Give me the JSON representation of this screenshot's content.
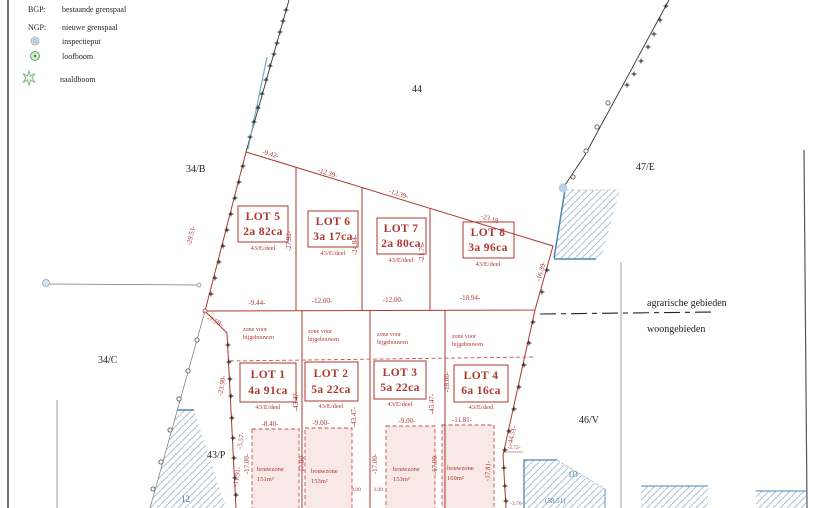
{
  "legend": {
    "bgp_key": "BGP:",
    "bgp_label": "bestaande grenspaal",
    "ngp_key": "NGP:",
    "ngp_label": "nieuwe grenspaal",
    "inspectieput": "inspectieput",
    "loofboom": "loofboom",
    "naaldboom": "naaldboom"
  },
  "parcels": {
    "top": "44",
    "upper_left": "34/B",
    "upper_right": "47/E",
    "mid_left": "34/C",
    "lower_left": "43/P",
    "lower_right": "46/V",
    "blue_left": "12",
    "blue_right": "1D",
    "blue_area": "(58.51)"
  },
  "zoning": {
    "above": "agrarische gebieden",
    "below": "woongebieden"
  },
  "lots": {
    "upper": [
      {
        "name": "LOT 5",
        "area": "2a 82ca",
        "ref": "43/E/deel"
      },
      {
        "name": "LOT 6",
        "area": "3a 17ca",
        "ref": "43/E/deel"
      },
      {
        "name": "LOT 7",
        "area": "2a 80ca",
        "ref": "43/E/deel"
      },
      {
        "name": "LOT 8",
        "area": "3a 96ca",
        "ref": "43/E/deel"
      }
    ],
    "lower": [
      {
        "name": "LOT 1",
        "area": "4a 91ca",
        "ref": "43/E/deel"
      },
      {
        "name": "LOT 2",
        "area": "5a 22ca",
        "ref": "43/E/deel"
      },
      {
        "name": "LOT 3",
        "area": "5a 22ca",
        "ref": "43/E/deel"
      },
      {
        "name": "LOT 4",
        "area": "6a 16ca",
        "ref": "43/E/deel"
      }
    ]
  },
  "zones": {
    "zone_line1": "zone voor",
    "zone_line2": "bijgebouwen",
    "bouwzone": "bouwzone",
    "areas": [
      "151m²",
      "153m²",
      "153m²",
      "169m²"
    ]
  },
  "dims": {
    "top": [
      "-9.42-",
      "-12.39-",
      "-12.39-",
      "-23.18-"
    ],
    "middle": [
      "-9.44-",
      "-12.00-",
      "-12.00-",
      "-18.94-"
    ],
    "bz_top": [
      "-8.40-",
      "-9.00-",
      "-9.00-",
      "-11.81-"
    ],
    "upper_left": "-29.51-",
    "upper_div": [
      "-27.92-",
      "-24.84-",
      "-21.76-"
    ],
    "upper_right": "-16.39-",
    "left_short": "-7.59-",
    "lower_left": [
      "-23.98-",
      "-5.57-",
      "-11.91-"
    ],
    "lower_div": [
      "-43.47-",
      "-43.47-",
      "-43.47-",
      "-18.00-"
    ],
    "lower_right": "-44.51-",
    "depth": "-17.00-",
    "depth_right": "-17.81-",
    "gap": [
      "3.00",
      "3.00"
    ],
    "small_right": [
      "-3.72-",
      "-3.76-"
    ]
  }
}
